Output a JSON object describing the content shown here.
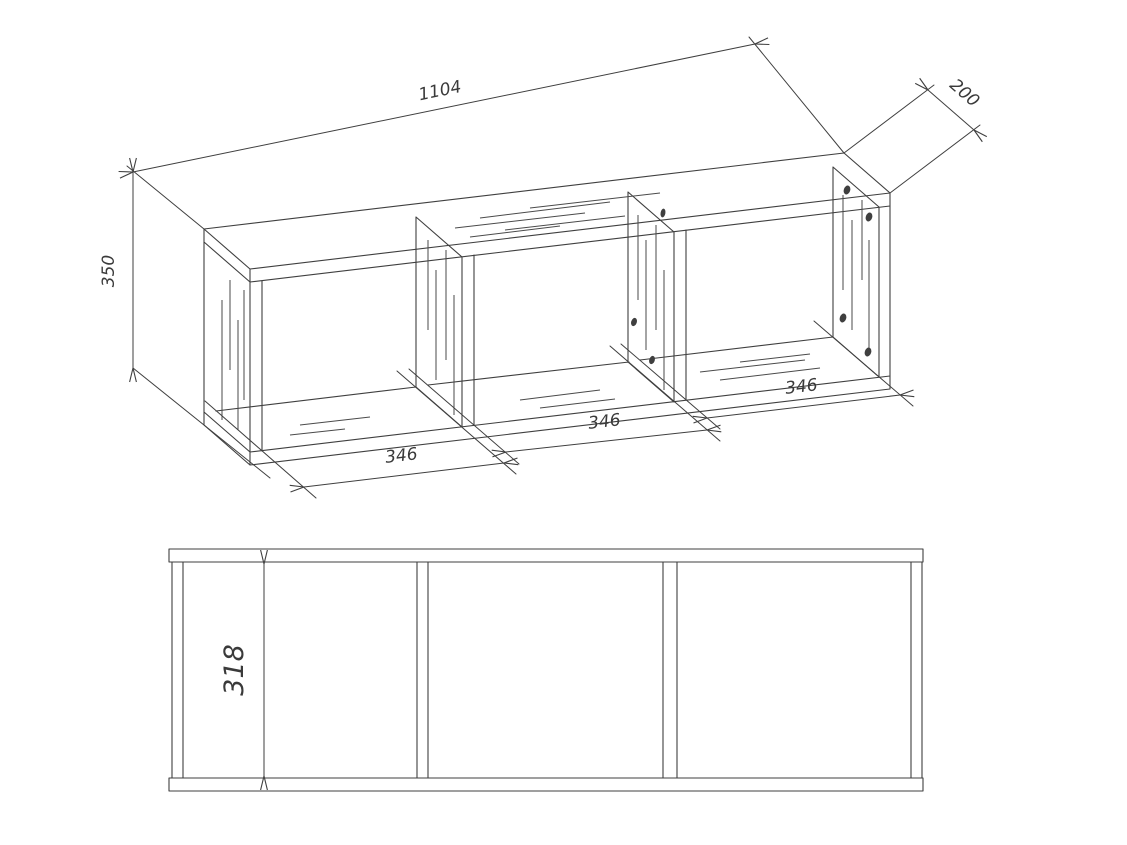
{
  "drawing": {
    "kind": "furniture technical drawing, two views (isometric and front elevation)",
    "colors": {
      "line": "#3f3f3f",
      "background": "#ffffff"
    },
    "dimensions": {
      "total_width": "1104",
      "depth": "200",
      "total_height": "350",
      "compartment_width_1": "346",
      "compartment_width_2": "346",
      "compartment_width_3": "346",
      "interior_height": "318"
    }
  }
}
